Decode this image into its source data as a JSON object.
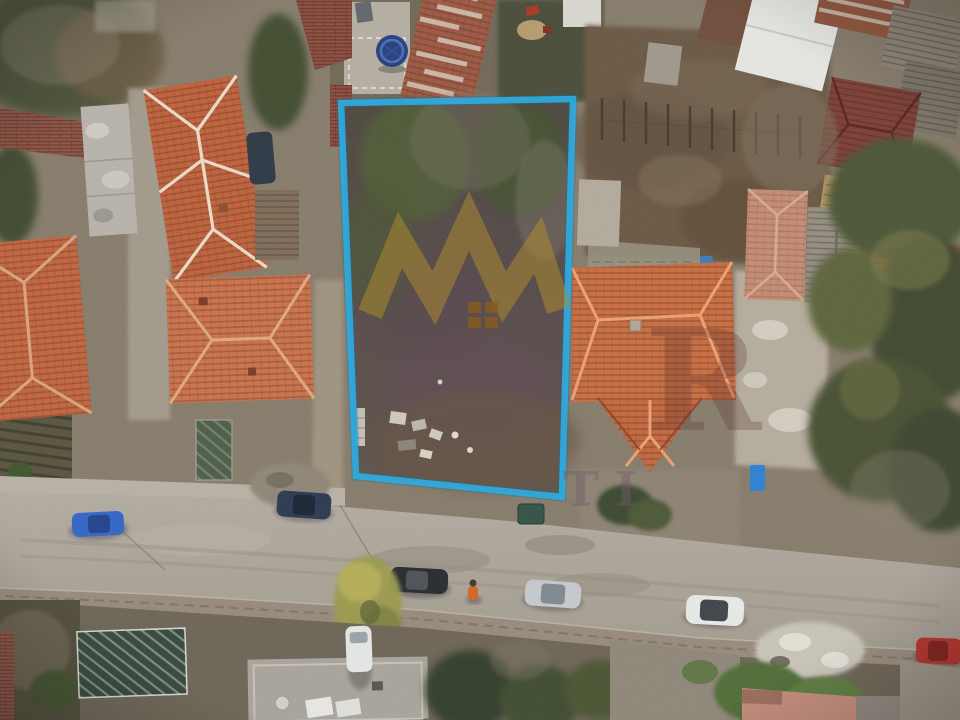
{
  "photo": {
    "kind": "aerial-drone-photograph",
    "subject": "vacant land plot outlined in blue within a residential neighborhood, street with parked cars below"
  },
  "colors": {
    "plot_outline": "#2fa9dc",
    "watermark_gold": "#b28e2b",
    "watermark_emblem_gold": "#8a5c1d"
  },
  "watermark": {
    "crown_icon": "crown-zigzag-icon",
    "letter_fragment_large": "R",
    "letter_fragment_small": "TI"
  }
}
